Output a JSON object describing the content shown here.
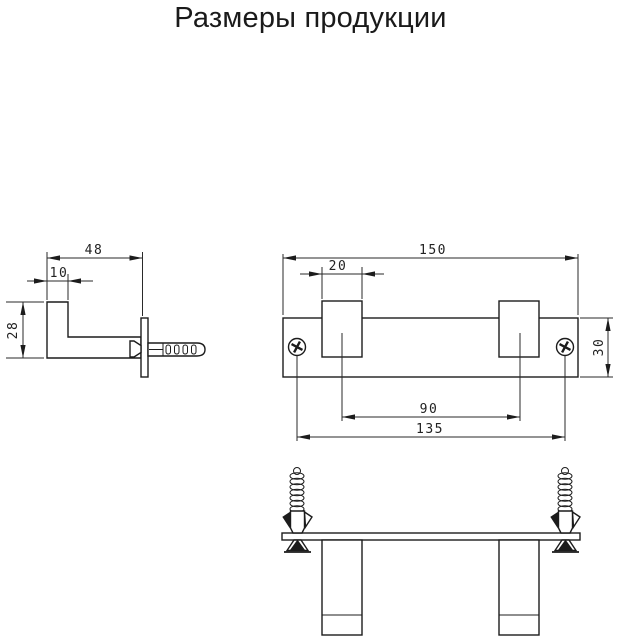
{
  "title": "Размеры продукции",
  "colors": {
    "background": "#ffffff",
    "line": "#1c1c1c"
  },
  "drawing": {
    "side_view": {
      "dims": {
        "depth": "48",
        "tip": "10",
        "height": "28"
      }
    },
    "front_view": {
      "dims": {
        "width": "150",
        "hook_width": "20",
        "plate_height": "30",
        "hook_spacing": "90",
        "mount_spacing": "135"
      }
    }
  }
}
